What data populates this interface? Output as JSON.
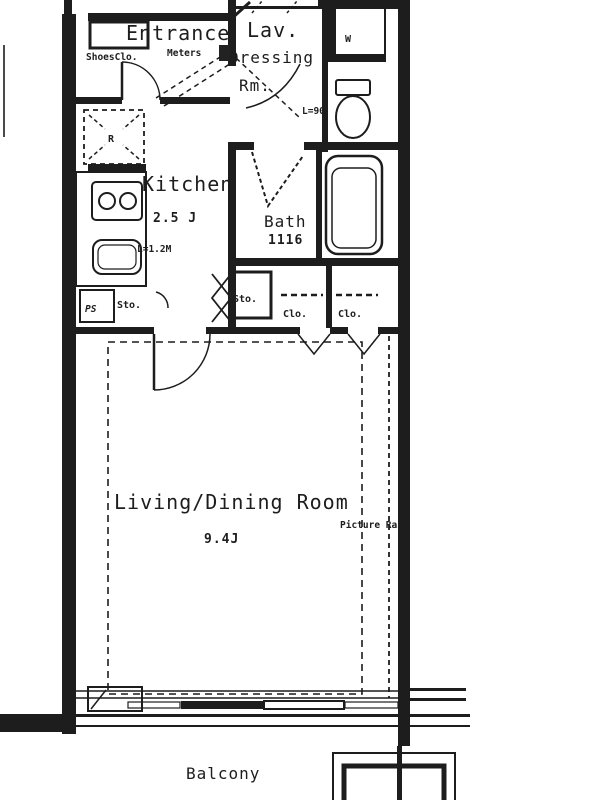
{
  "floorplan": {
    "rooms": {
      "entrance": {
        "label": "Entrance"
      },
      "lavatory": {
        "label": "Lav.",
        "counter_length": "L=90"
      },
      "dressing": {
        "label_line1": "Dressing",
        "label_line2": "Rm."
      },
      "kitchen": {
        "label": "Kitchen",
        "size": "2.5 J",
        "counter_length": "L=1.2M"
      },
      "bath": {
        "label": "Bath",
        "size": "1116"
      },
      "living_dining": {
        "label": "Living/Dining Room",
        "size": "9.4J"
      },
      "balcony": {
        "label": "Balcony"
      }
    },
    "storage": {
      "shoes_closet": "ShoesClo.",
      "storage1": "Sto.",
      "storage2": "Sto.",
      "closet1": "Clo.",
      "closet2": "Clo."
    },
    "annotations": {
      "meters": "Meters",
      "picture_rail": "Picture Rail",
      "refrigerator_space": "R",
      "washer_space": "W",
      "pipe_space": "PS"
    },
    "colors": {
      "line": "#1d1d1d",
      "background": "#ffffff"
    }
  }
}
